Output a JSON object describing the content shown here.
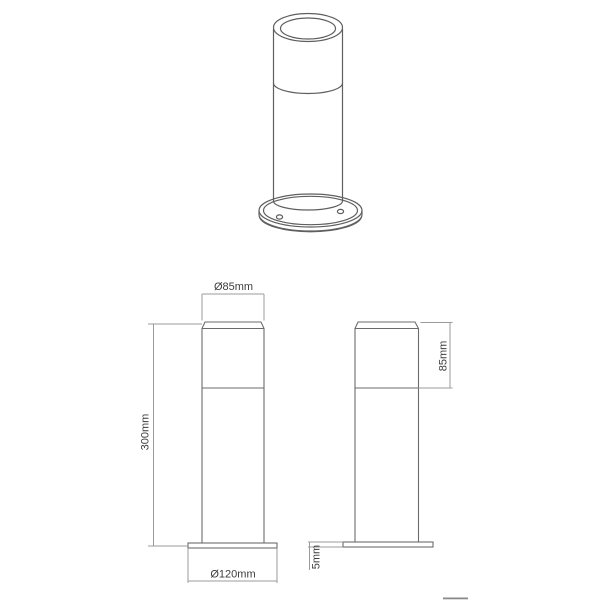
{
  "page": {
    "background": "#ffffff"
  },
  "drawing": {
    "type": "technical-drawing",
    "subject": "cylindrical bollard light with round screw-hole base plate",
    "colors": {
      "object_line": "#6b6b6b",
      "dimension_line": "#9b9b9b",
      "label_text": "#3d3d3d",
      "artifact_mark": "#8a8a8a"
    },
    "views": {
      "perspective": {
        "name": "perspective view (top of page)"
      },
      "front": {
        "name": "front elevation (bottom left)",
        "dim_top_diameter": "Ø85mm",
        "dim_height": "300mm",
        "dim_base_diameter": "Ø120mm"
      },
      "side": {
        "name": "side elevation (bottom right)",
        "dim_head_height": "85mm",
        "dim_base_thickness": "5mm"
      }
    }
  }
}
